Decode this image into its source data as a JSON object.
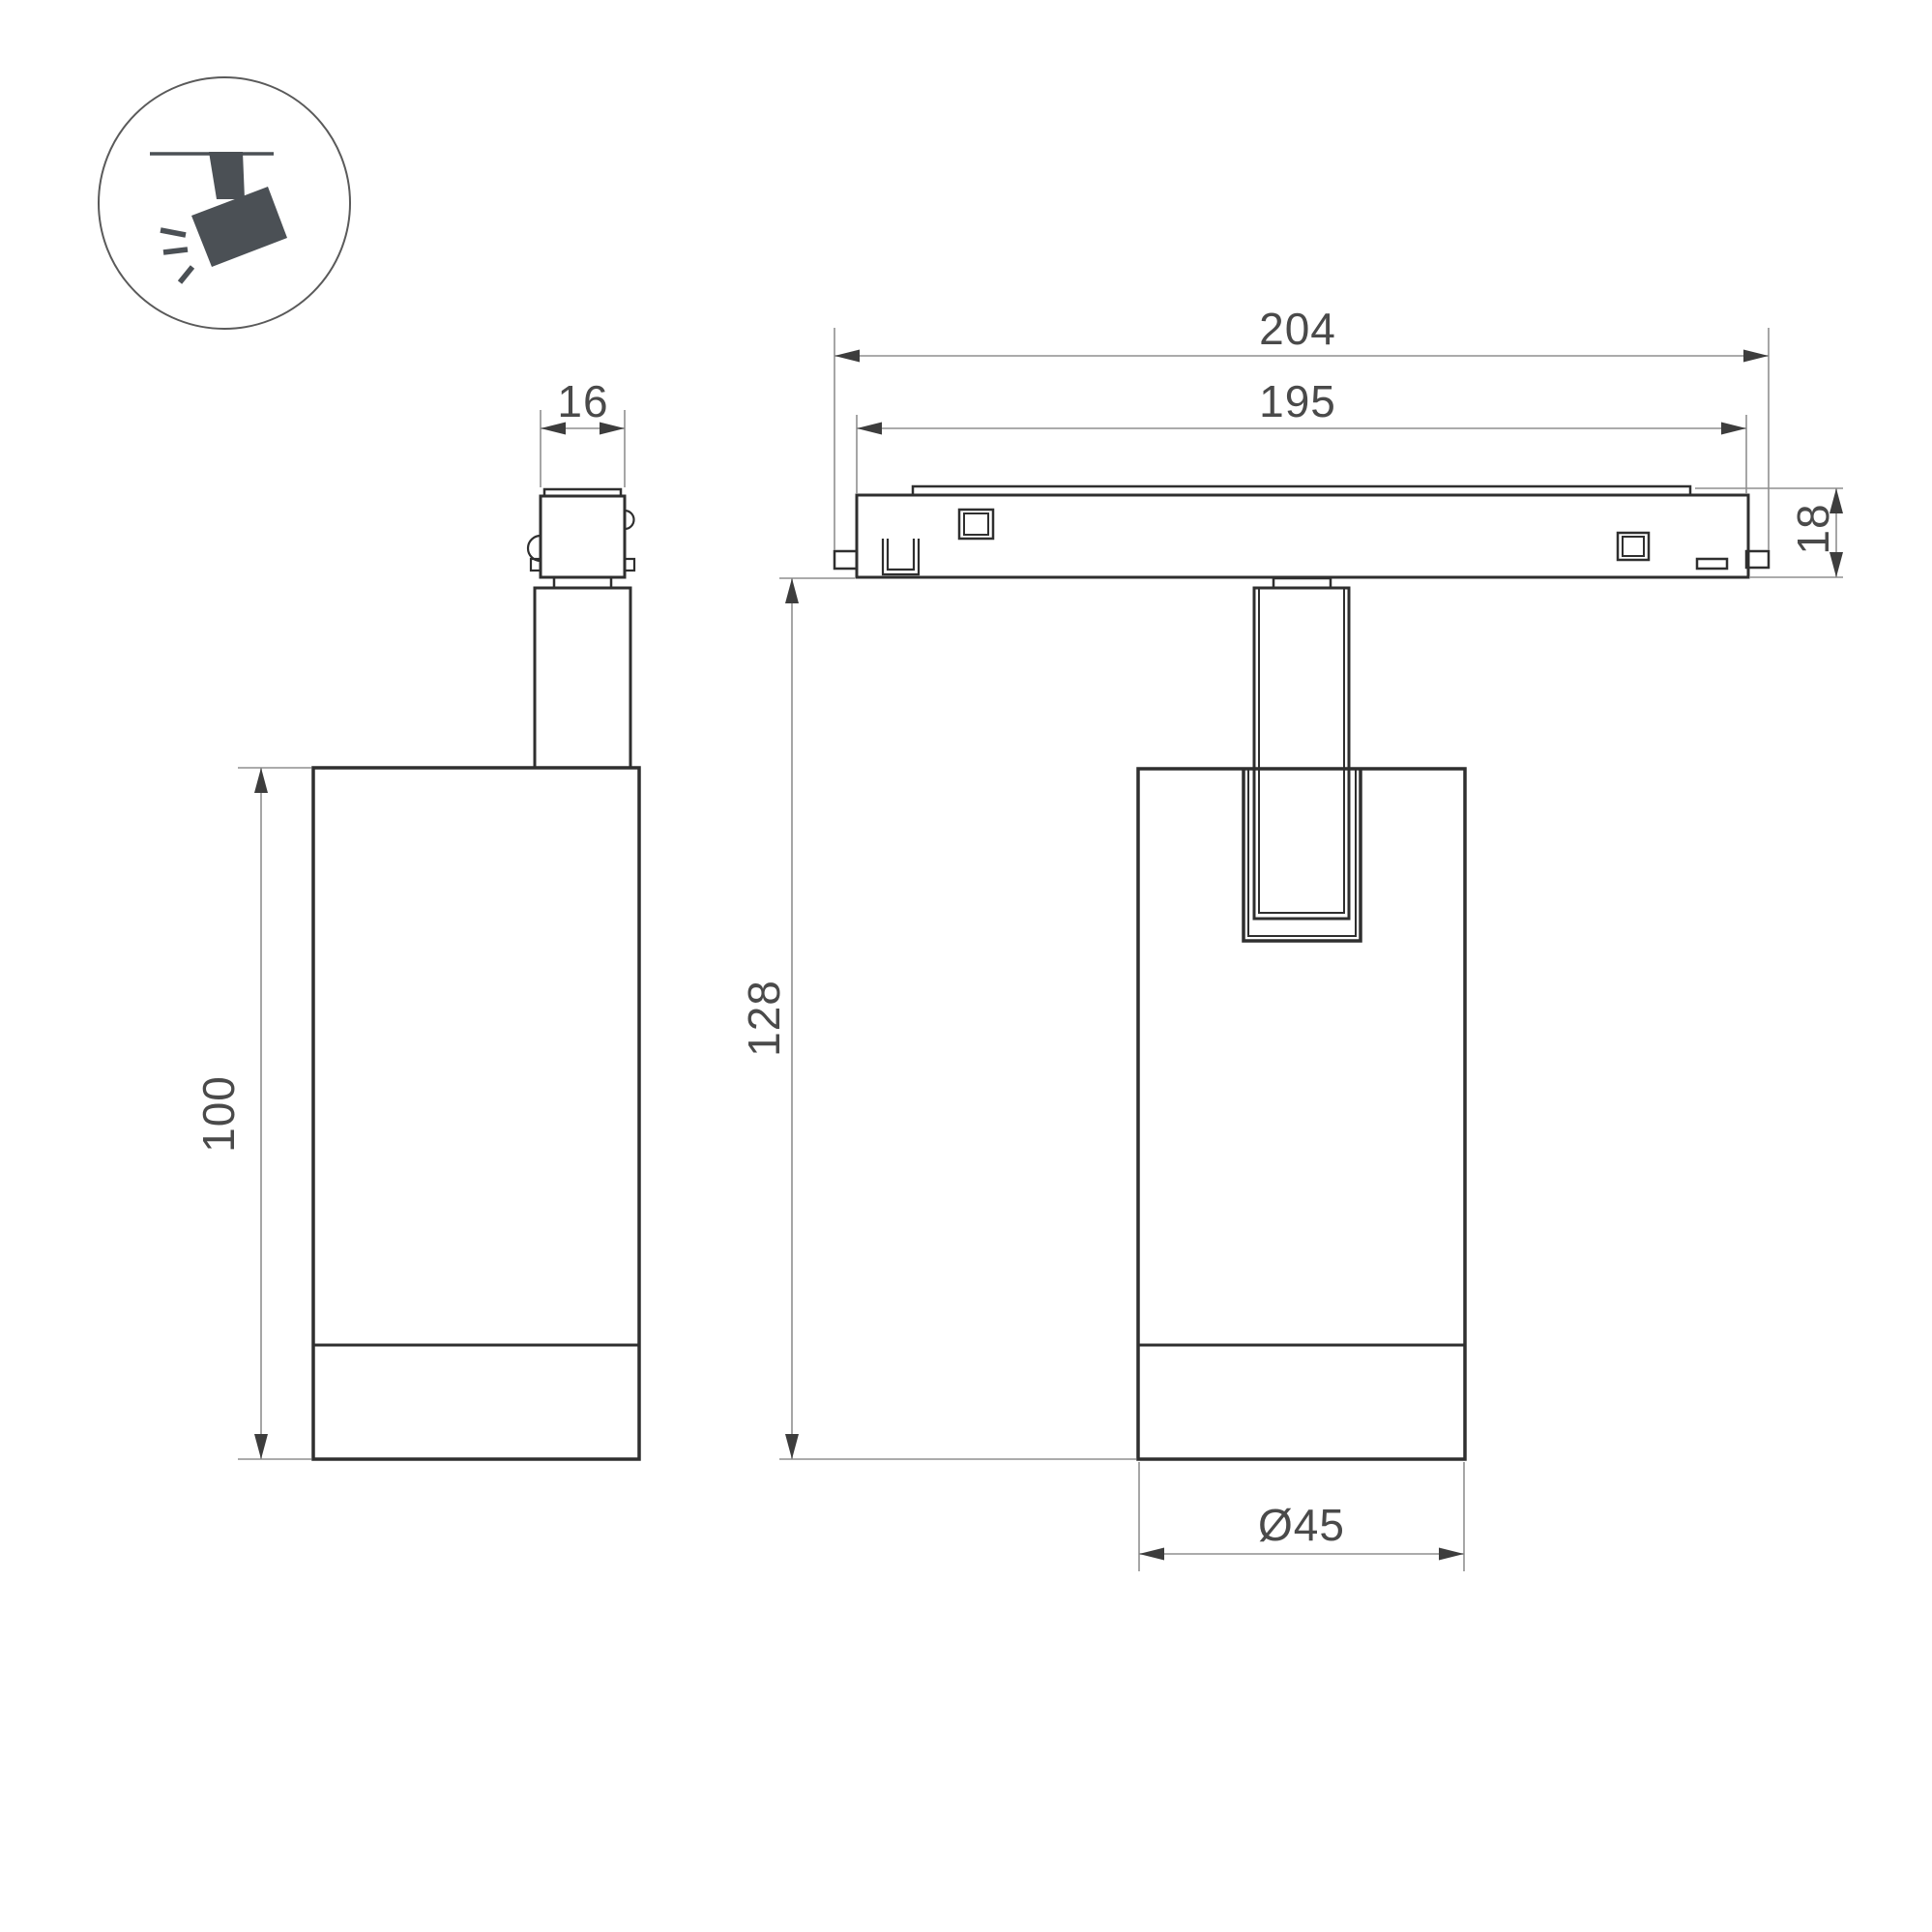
{
  "title": "Track spotlight dimensional drawing",
  "icon": {
    "label": "track-spotlight-pictogram"
  },
  "views": {
    "side_view": {
      "dim_connector_width": "16",
      "dim_body_height": "100"
    },
    "front_view": {
      "dim_track_overall_length": "204",
      "dim_track_body_length": "195",
      "dim_track_height": "18",
      "dim_overall_height": "128",
      "dim_body_diameter": "Ø45"
    }
  },
  "colors": {
    "background": "#ffffff",
    "outline": "#2f2f2f",
    "dimension": "#8f8f8f",
    "arrow": "#3d3d3d",
    "text": "#4a4a4a",
    "icon": "#4b5055"
  }
}
